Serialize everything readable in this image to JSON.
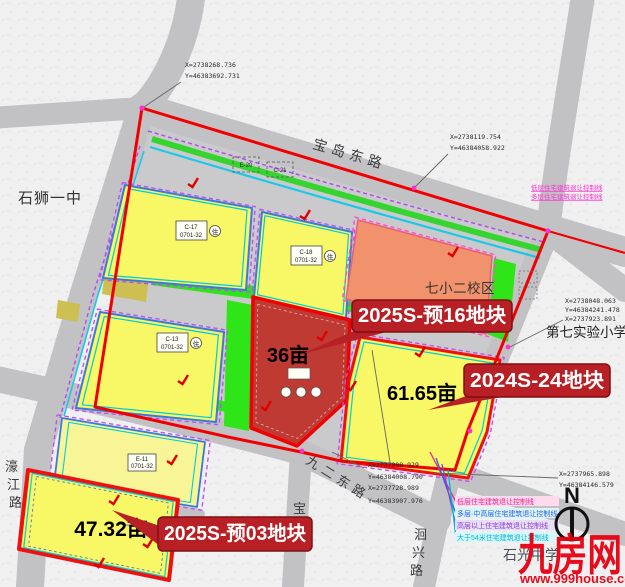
{
  "roads": {
    "baodao": "宝岛东路",
    "haojiang": "濠江路",
    "baohui": "宝晖路",
    "jiuer": "九二东路",
    "huixing": "洄兴路"
  },
  "places": {
    "yizhong": "石狮一中",
    "qixiao": "七小二校区",
    "shiyan": "第七实验小学",
    "shiguang": "石光中学"
  },
  "callouts": {
    "pre16": {
      "label": "2025S-预16地块",
      "area": "36亩"
    },
    "s24": {
      "label": "2024S-24地块",
      "area": "61.65亩"
    },
    "pre03": {
      "label": "2025S-预03地块",
      "area": "47.32亩"
    }
  },
  "codes": {
    "c17": {
      "l1": "C-17",
      "l2": "0701-32",
      "use": "住"
    },
    "c18": {
      "l1": "C-18",
      "l2": "0701-32",
      "use": "住"
    },
    "c13": {
      "l1": "C-13",
      "l2": "0701-32",
      "use": "住"
    },
    "e11": {
      "l1": "E-11",
      "l2": "0701-32"
    },
    "e20": {
      "l1": "E-20"
    },
    "c21": {
      "l1": "C-21"
    }
  },
  "coords": {
    "c1": [
      "X=2738268.736",
      "Y=46383692.731"
    ],
    "c2": [
      "X=2738119.754",
      "Y=46384058.922"
    ],
    "c3": [
      "X=2738048.063",
      "Y=46384241.478",
      "X=2737923.891"
    ],
    "c4": [
      "X=2737908.929",
      "Y=46384008.790",
      "X=2737728.989",
      "Y=46383907.976"
    ],
    "c5": [
      "X=2737965.898",
      "Y=46384146.579"
    ]
  },
  "notes": {
    "top": [
      "低层住宅建筑退让控制线",
      "多层住宅建筑退让控制线"
    ]
  },
  "legend": {
    "items": [
      {
        "label": "低层住宅建筑退让控制线",
        "color": "#e9258f"
      },
      {
        "label": "多层·中高层住宅建筑退让控制线",
        "color": "#2f5fe0"
      },
      {
        "label": "高层以上住宅建筑退让控制线",
        "color": "#8e3fd0"
      },
      {
        "label": "大于54米住宅建筑退让控制线",
        "color": "#00b6d4"
      }
    ]
  },
  "compass": {
    "n": "N"
  },
  "watermark": {
    "logo": "九房网",
    "url": "www.999house.com"
  },
  "colors": {
    "callout_red": "#b82025",
    "boundary_red": "#f00000",
    "watermark_red": "#e60012",
    "parcel_yellow": "#f8f765",
    "parcel_pale_yellow": "#f7f595",
    "parcel_orange": "#f2926c",
    "parcel_dark_red": "#bf3a33",
    "green": "#2ee517",
    "road_gray": "#c2c2c5"
  }
}
